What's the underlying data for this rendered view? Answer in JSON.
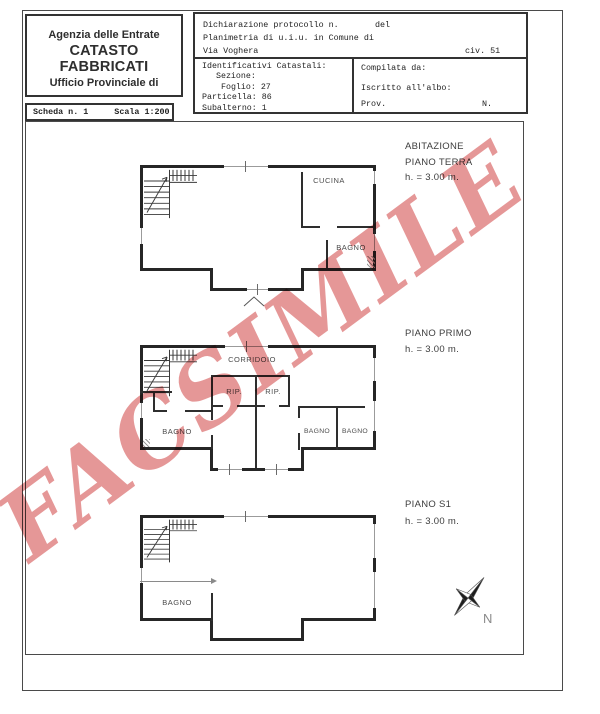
{
  "document": {
    "agency": {
      "line1": "Agenzia delle Entrate",
      "line2": "CATASTO FABBRICATI",
      "line3": "Ufficio Provinciale di"
    },
    "declaration": {
      "protocol_label": "Dichiarazione protocollo n.",
      "del_label": "del",
      "planimetria_label": "Planimetria di u.i.u. in Comune di",
      "street": "Via Voghera",
      "civic": "civ. 51"
    },
    "cadastral": {
      "title": "Identificativi Catastali:",
      "sezione": "Sezione:",
      "foglio": "Foglio: 27",
      "particella": "Particella: 86",
      "subalterno": "Subalterno: 1"
    },
    "compiler": {
      "compilata": "Compilata da:",
      "iscritto": "Iscritto all'albo:",
      "prov": "Prov.",
      "n": "N."
    },
    "sheet": {
      "scheda": "Scheda n. 1",
      "scala": "Scala 1:200"
    }
  },
  "watermark": {
    "text": "FACSIMILE",
    "color": "#e28989"
  },
  "floors": {
    "terra": {
      "title": "ABITAZIONE",
      "subtitle": "PIANO TERRA",
      "height": "h. = 3.00 m.",
      "rooms": {
        "cucina": "CUCINA",
        "bagno": "BAGNO"
      }
    },
    "primo": {
      "subtitle": "PIANO PRIMO",
      "height": "h. = 3.00 m.",
      "rooms": {
        "corridoio": "CORRIDOIO",
        "rip1": "RIP.",
        "rip2": "RIP.",
        "bagno1": "BAGNO",
        "bagno2": "BAGNO",
        "bagno3": "BAGNO"
      }
    },
    "s1": {
      "subtitle": "PIANO S1",
      "height": "h. = 3.00 m.",
      "rooms": {
        "bagno": "BAGNO"
      }
    }
  },
  "compass": {
    "north_label": "N"
  }
}
